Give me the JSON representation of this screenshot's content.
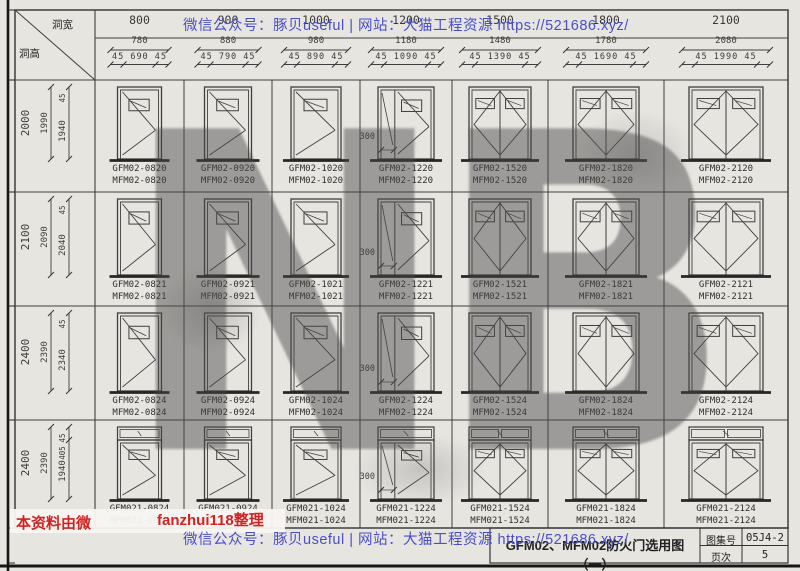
{
  "watermarks": {
    "top_line": "微信公众号：豚贝useful | 网站：大猫工程资源 https://521686.xyz/",
    "bottom_line": "微信公众号：豚贝useful | 网站：大猫工程资源 https://521686.xyz/",
    "left_red": "本资料由微",
    "editor_red": "fanzhui118整理",
    "big_letters": "NB",
    "red_color": "#d42222",
    "blue_color": "#4a4fc8"
  },
  "header": {
    "corner_width_label": "洞宽",
    "corner_height_label": "洞高",
    "columns": [
      {
        "hole": "800",
        "frame": "780",
        "leafs": "45 690 45"
      },
      {
        "hole": "900",
        "frame": "880",
        "leafs": "45 790 45"
      },
      {
        "hole": "1000",
        "frame": "980",
        "leafs": "45 890 45"
      },
      {
        "hole": "1200",
        "frame": "1180",
        "leafs": "45 1090 45"
      },
      {
        "hole": "1500",
        "frame": "1480",
        "leafs": "45 1390 45"
      },
      {
        "hole": "1800",
        "frame": "1780",
        "leafs": "45 1690 45"
      },
      {
        "hole": "2100",
        "frame": "2080",
        "leafs": "45 1990 45"
      }
    ]
  },
  "rows": [
    {
      "hole": "2000",
      "frame": "1990",
      "leaf": "1940",
      "top_gap": "45"
    },
    {
      "hole": "2100",
      "frame": "2090",
      "leaf": "2040",
      "top_gap": "45"
    },
    {
      "hole": "2400",
      "frame": "2390",
      "leaf": "2340",
      "top_gap": "45"
    },
    {
      "hole": "2400",
      "frame": "2390",
      "leaf": "1940",
      "top_gap": "45",
      "transom": "405"
    }
  ],
  "narrow_leaf_dim": "300",
  "cells": [
    [
      [
        "GFM02-0820",
        "MFM02-0820"
      ],
      [
        "GFM02-0920",
        "MFM02-0920"
      ],
      [
        "GFM02-1020",
        "MFM02-1020"
      ],
      [
        "GFM02-1220",
        "MFM02-1220"
      ],
      [
        "GFM02-1520",
        "MFM02-1520"
      ],
      [
        "GFM02-1820",
        "MFM02-1820"
      ],
      [
        "GFM02-2120",
        "MFM02-2120"
      ]
    ],
    [
      [
        "GFM02-0821",
        "MFM02-0821"
      ],
      [
        "GFM02-0921",
        "MFM02-0921"
      ],
      [
        "GFM02-1021",
        "MFM02-1021"
      ],
      [
        "GFM02-1221",
        "MFM02-1221"
      ],
      [
        "GFM02-1521",
        "MFM02-1521"
      ],
      [
        "GFM02-1821",
        "MFM02-1821"
      ],
      [
        "GFM02-2121",
        "MFM02-2121"
      ]
    ],
    [
      [
        "GFM02-0824",
        "MFM02-0824"
      ],
      [
        "GFM02-0924",
        "MFM02-0924"
      ],
      [
        "GFM02-1024",
        "MFM02-1024"
      ],
      [
        "GFM02-1224",
        "MFM02-1224"
      ],
      [
        "GFM02-1524",
        "MFM02-1524"
      ],
      [
        "GFM02-1824",
        "MFM02-1824"
      ],
      [
        "GFM02-2124",
        "MFM02-2124"
      ]
    ],
    [
      [
        "GFM021-0824",
        "MFM021-0824"
      ],
      [
        "GFM021-0924",
        "MFM021-0924"
      ],
      [
        "GFM021-1024",
        "MFM021-1024"
      ],
      [
        "GFM021-1224",
        "MFM021-1224"
      ],
      [
        "GFM021-1524",
        "MFM021-1524"
      ],
      [
        "GFM021-1824",
        "MFM021-1824"
      ],
      [
        "GFM021-2124",
        "MFM021-2124"
      ]
    ]
  ],
  "title_block": {
    "title": "GFM02、MFM02防火门选用图（一）",
    "atlas_label": "图集号",
    "atlas_value": "05J4-2",
    "page_label": "页次",
    "page_value": "5"
  }
}
